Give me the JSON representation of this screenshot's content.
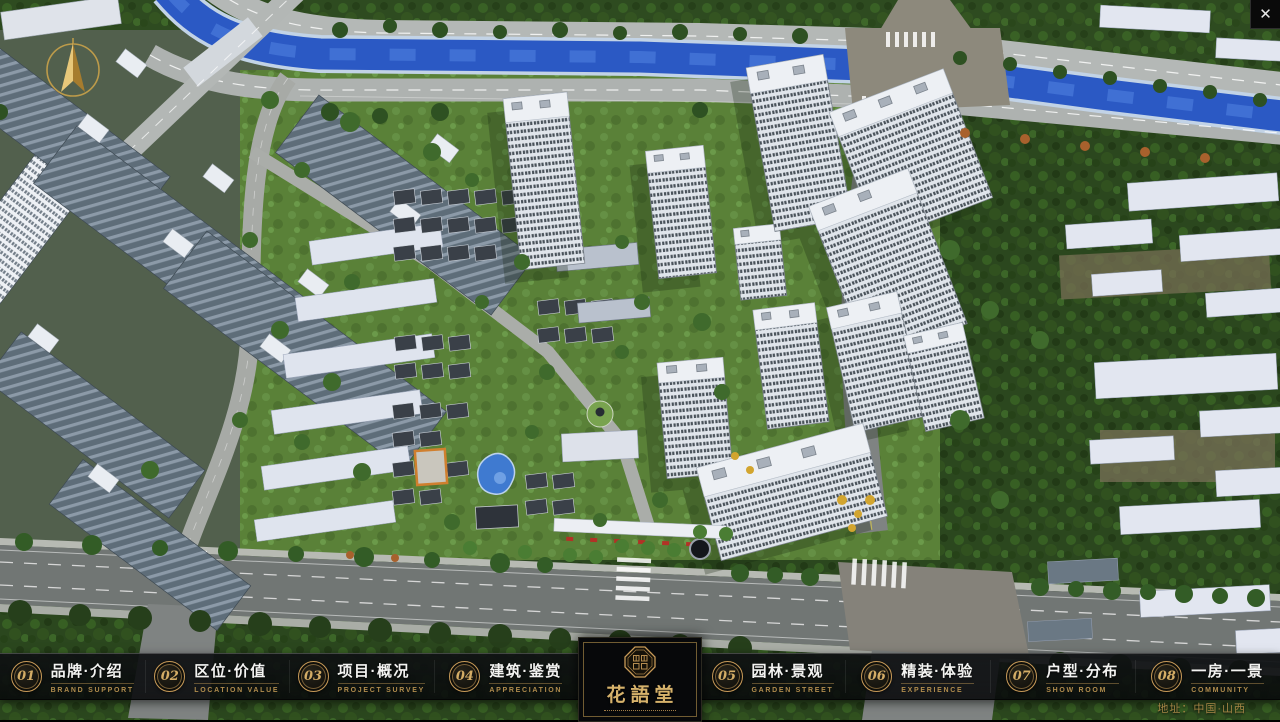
{
  "close": {
    "glyph": "✕"
  },
  "logo": {
    "title": "花語堂"
  },
  "nav": {
    "items": [
      {
        "num": "01",
        "zh": "品牌·介绍",
        "en": "BRAND SUPPORT"
      },
      {
        "num": "02",
        "zh": "区位·价值",
        "en": "LOCATION VALUE"
      },
      {
        "num": "03",
        "zh": "项目·概况",
        "en": "PROJECT SURVEY"
      },
      {
        "num": "04",
        "zh": "建筑·鉴赏",
        "en": "APPRECIATION"
      },
      {
        "num": "05",
        "zh": "园林·景观",
        "en": "GARDEN STREET"
      },
      {
        "num": "06",
        "zh": "精装·体验",
        "en": "EXPERIENCE"
      },
      {
        "num": "07",
        "zh": "户型·分布",
        "en": "SHOW ROOM"
      },
      {
        "num": "08",
        "zh": "一房·一景",
        "en": "COMMUNITY"
      }
    ]
  },
  "footer": {
    "address": "地址：中国·山西"
  },
  "colors": {
    "accent_gold": "#c79a58",
    "river_blue": "#2b59c4",
    "navbar_bg": "#0b0d0f"
  }
}
